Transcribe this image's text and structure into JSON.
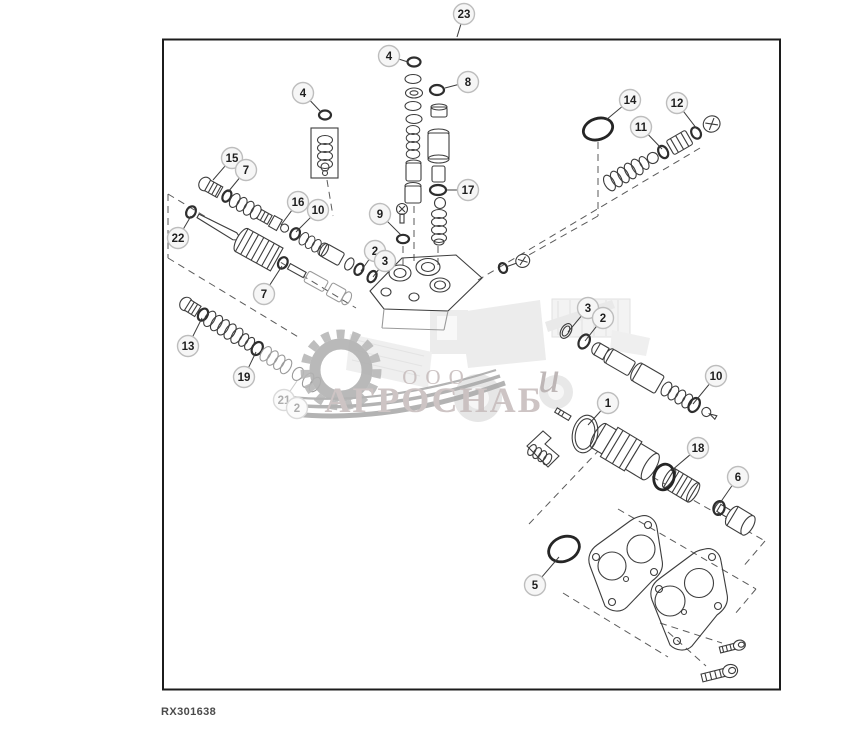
{
  "figure_label": "RX301638",
  "watermark": {
    "company_prefix": "ООО",
    "company_name": "АГРОСНАБ",
    "script_letter": "u"
  },
  "colors": {
    "line": "#3d3d3d",
    "border": "#1c1c1c",
    "watermark_text": "#c8bebe",
    "watermark_gear": "#b2b2b2",
    "callout_stroke": "#bdbdbd"
  },
  "callouts": [
    {
      "n": "23",
      "cx": 464,
      "cy": 14,
      "tx": 457,
      "ty": 37
    },
    {
      "n": "4",
      "cx": 389,
      "cy": 56,
      "tx": 408,
      "ty": 62
    },
    {
      "n": "8",
      "cx": 468,
      "cy": 82,
      "tx": 445,
      "ty": 88
    },
    {
      "n": "4",
      "cx": 303,
      "cy": 93,
      "tx": 320,
      "ty": 111
    },
    {
      "n": "14",
      "cx": 630,
      "cy": 100,
      "tx": 606,
      "ty": 120
    },
    {
      "n": "12",
      "cx": 677,
      "cy": 103,
      "tx": 697,
      "ty": 129
    },
    {
      "n": "11",
      "cx": 641,
      "cy": 127,
      "tx": 662,
      "ty": 149
    },
    {
      "n": "15",
      "cx": 232,
      "cy": 158,
      "tx": 213,
      "ty": 180
    },
    {
      "n": "7",
      "cx": 246,
      "cy": 170,
      "tx": 228,
      "ty": 192
    },
    {
      "n": "17",
      "cx": 468,
      "cy": 190,
      "tx": 447,
      "ty": 190
    },
    {
      "n": "16",
      "cx": 298,
      "cy": 202,
      "tx": 281,
      "ty": 225
    },
    {
      "n": "10",
      "cx": 318,
      "cy": 210,
      "tx": 296,
      "ty": 232
    },
    {
      "n": "9",
      "cx": 380,
      "cy": 214,
      "tx": 401,
      "ty": 235
    },
    {
      "n": "22",
      "cx": 178,
      "cy": 238,
      "tx": 191,
      "ty": 216
    },
    {
      "n": "2",
      "cx": 375,
      "cy": 251,
      "tx": 361,
      "ty": 271
    },
    {
      "n": "3",
      "cx": 385,
      "cy": 261,
      "tx": 373,
      "ty": 277
    },
    {
      "n": "7",
      "cx": 264,
      "cy": 294,
      "tx": 282,
      "ty": 266
    },
    {
      "n": "3",
      "cx": 588,
      "cy": 308,
      "tx": 568,
      "ty": 332
    },
    {
      "n": "2",
      "cx": 603,
      "cy": 318,
      "tx": 585,
      "ty": 341
    },
    {
      "n": "13",
      "cx": 188,
      "cy": 346,
      "tx": 202,
      "ty": 318
    },
    {
      "n": "10",
      "cx": 716,
      "cy": 376,
      "tx": 693,
      "ty": 404
    },
    {
      "n": "19",
      "cx": 244,
      "cy": 377,
      "tx": 256,
      "ty": 352
    },
    {
      "n": "21",
      "cx": 284,
      "cy": 400,
      "tx": 297,
      "ty": 381,
      "faint": true
    },
    {
      "n": "2",
      "cx": 297,
      "cy": 408,
      "faint": true
    },
    {
      "n": "1",
      "cx": 608,
      "cy": 403,
      "tx": 588,
      "ty": 425
    },
    {
      "n": "18",
      "cx": 698,
      "cy": 448,
      "tx": 671,
      "ty": 471
    },
    {
      "n": "6",
      "cx": 738,
      "cy": 477,
      "tx": 720,
      "ty": 503
    },
    {
      "n": "5",
      "cx": 535,
      "cy": 585,
      "tx": 559,
      "ty": 557
    }
  ]
}
